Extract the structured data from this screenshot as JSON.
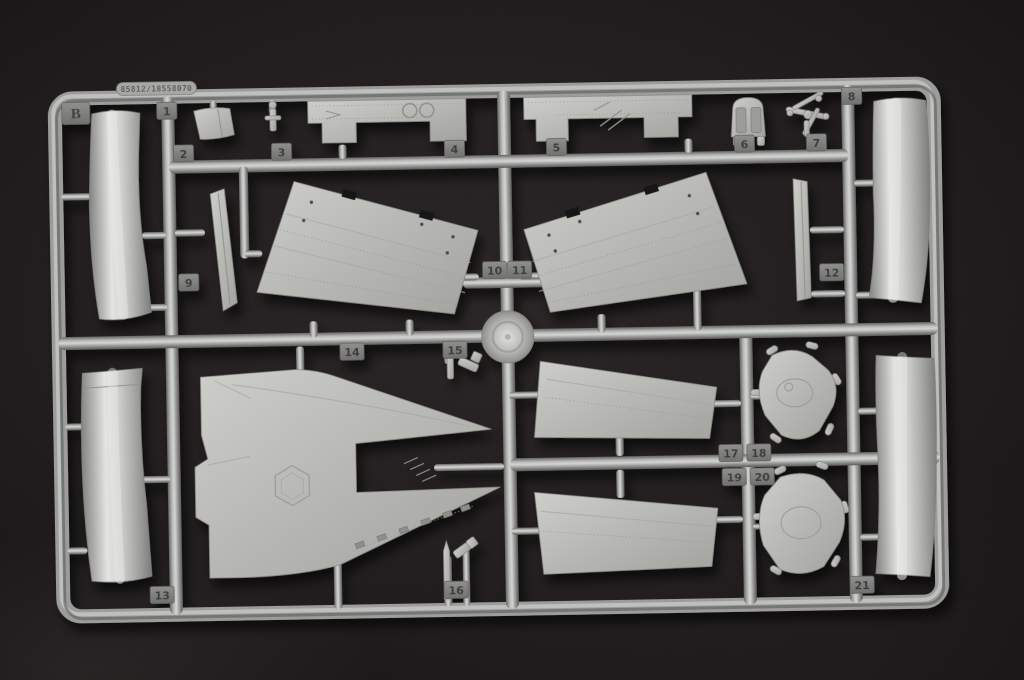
{
  "sprue": {
    "corner_tab_label": "B",
    "mold_stamp": "85812/18558070",
    "part_tabs": [
      {
        "label": "1",
        "x": 171,
        "y": 105
      },
      {
        "label": "2",
        "x": 187,
        "y": 148
      },
      {
        "label": "3",
        "x": 285,
        "y": 148
      },
      {
        "label": "4",
        "x": 458,
        "y": 148
      },
      {
        "label": "5",
        "x": 560,
        "y": 148
      },
      {
        "label": "6",
        "x": 748,
        "y": 148
      },
      {
        "label": "7",
        "x": 820,
        "y": 148
      },
      {
        "label": "8",
        "x": 856,
        "y": 102
      },
      {
        "label": "9",
        "x": 190,
        "y": 277
      },
      {
        "label": "10",
        "x": 496,
        "y": 270
      },
      {
        "label": "11",
        "x": 521,
        "y": 270
      },
      {
        "label": "12",
        "x": 833,
        "y": 278
      },
      {
        "label": "13",
        "x": 158,
        "y": 589
      },
      {
        "label": "14",
        "x": 352,
        "y": 349
      },
      {
        "label": "15",
        "x": 455,
        "y": 349
      },
      {
        "label": "16",
        "x": 452,
        "y": 589
      },
      {
        "label": "17",
        "x": 729,
        "y": 457
      },
      {
        "label": "18",
        "x": 757,
        "y": 457
      },
      {
        "label": "19",
        "x": 732,
        "y": 481
      },
      {
        "label": "20",
        "x": 760,
        "y": 481
      },
      {
        "label": "21",
        "x": 858,
        "y": 591
      }
    ],
    "colors": {
      "background": "#171314",
      "plastic_light": "#c4c5c1",
      "plastic_mid": "#9c9d9a",
      "plastic_dark": "#5c5d5b",
      "tab_face": "#7e7f7c",
      "engraving": "#3e3f3d"
    }
  }
}
